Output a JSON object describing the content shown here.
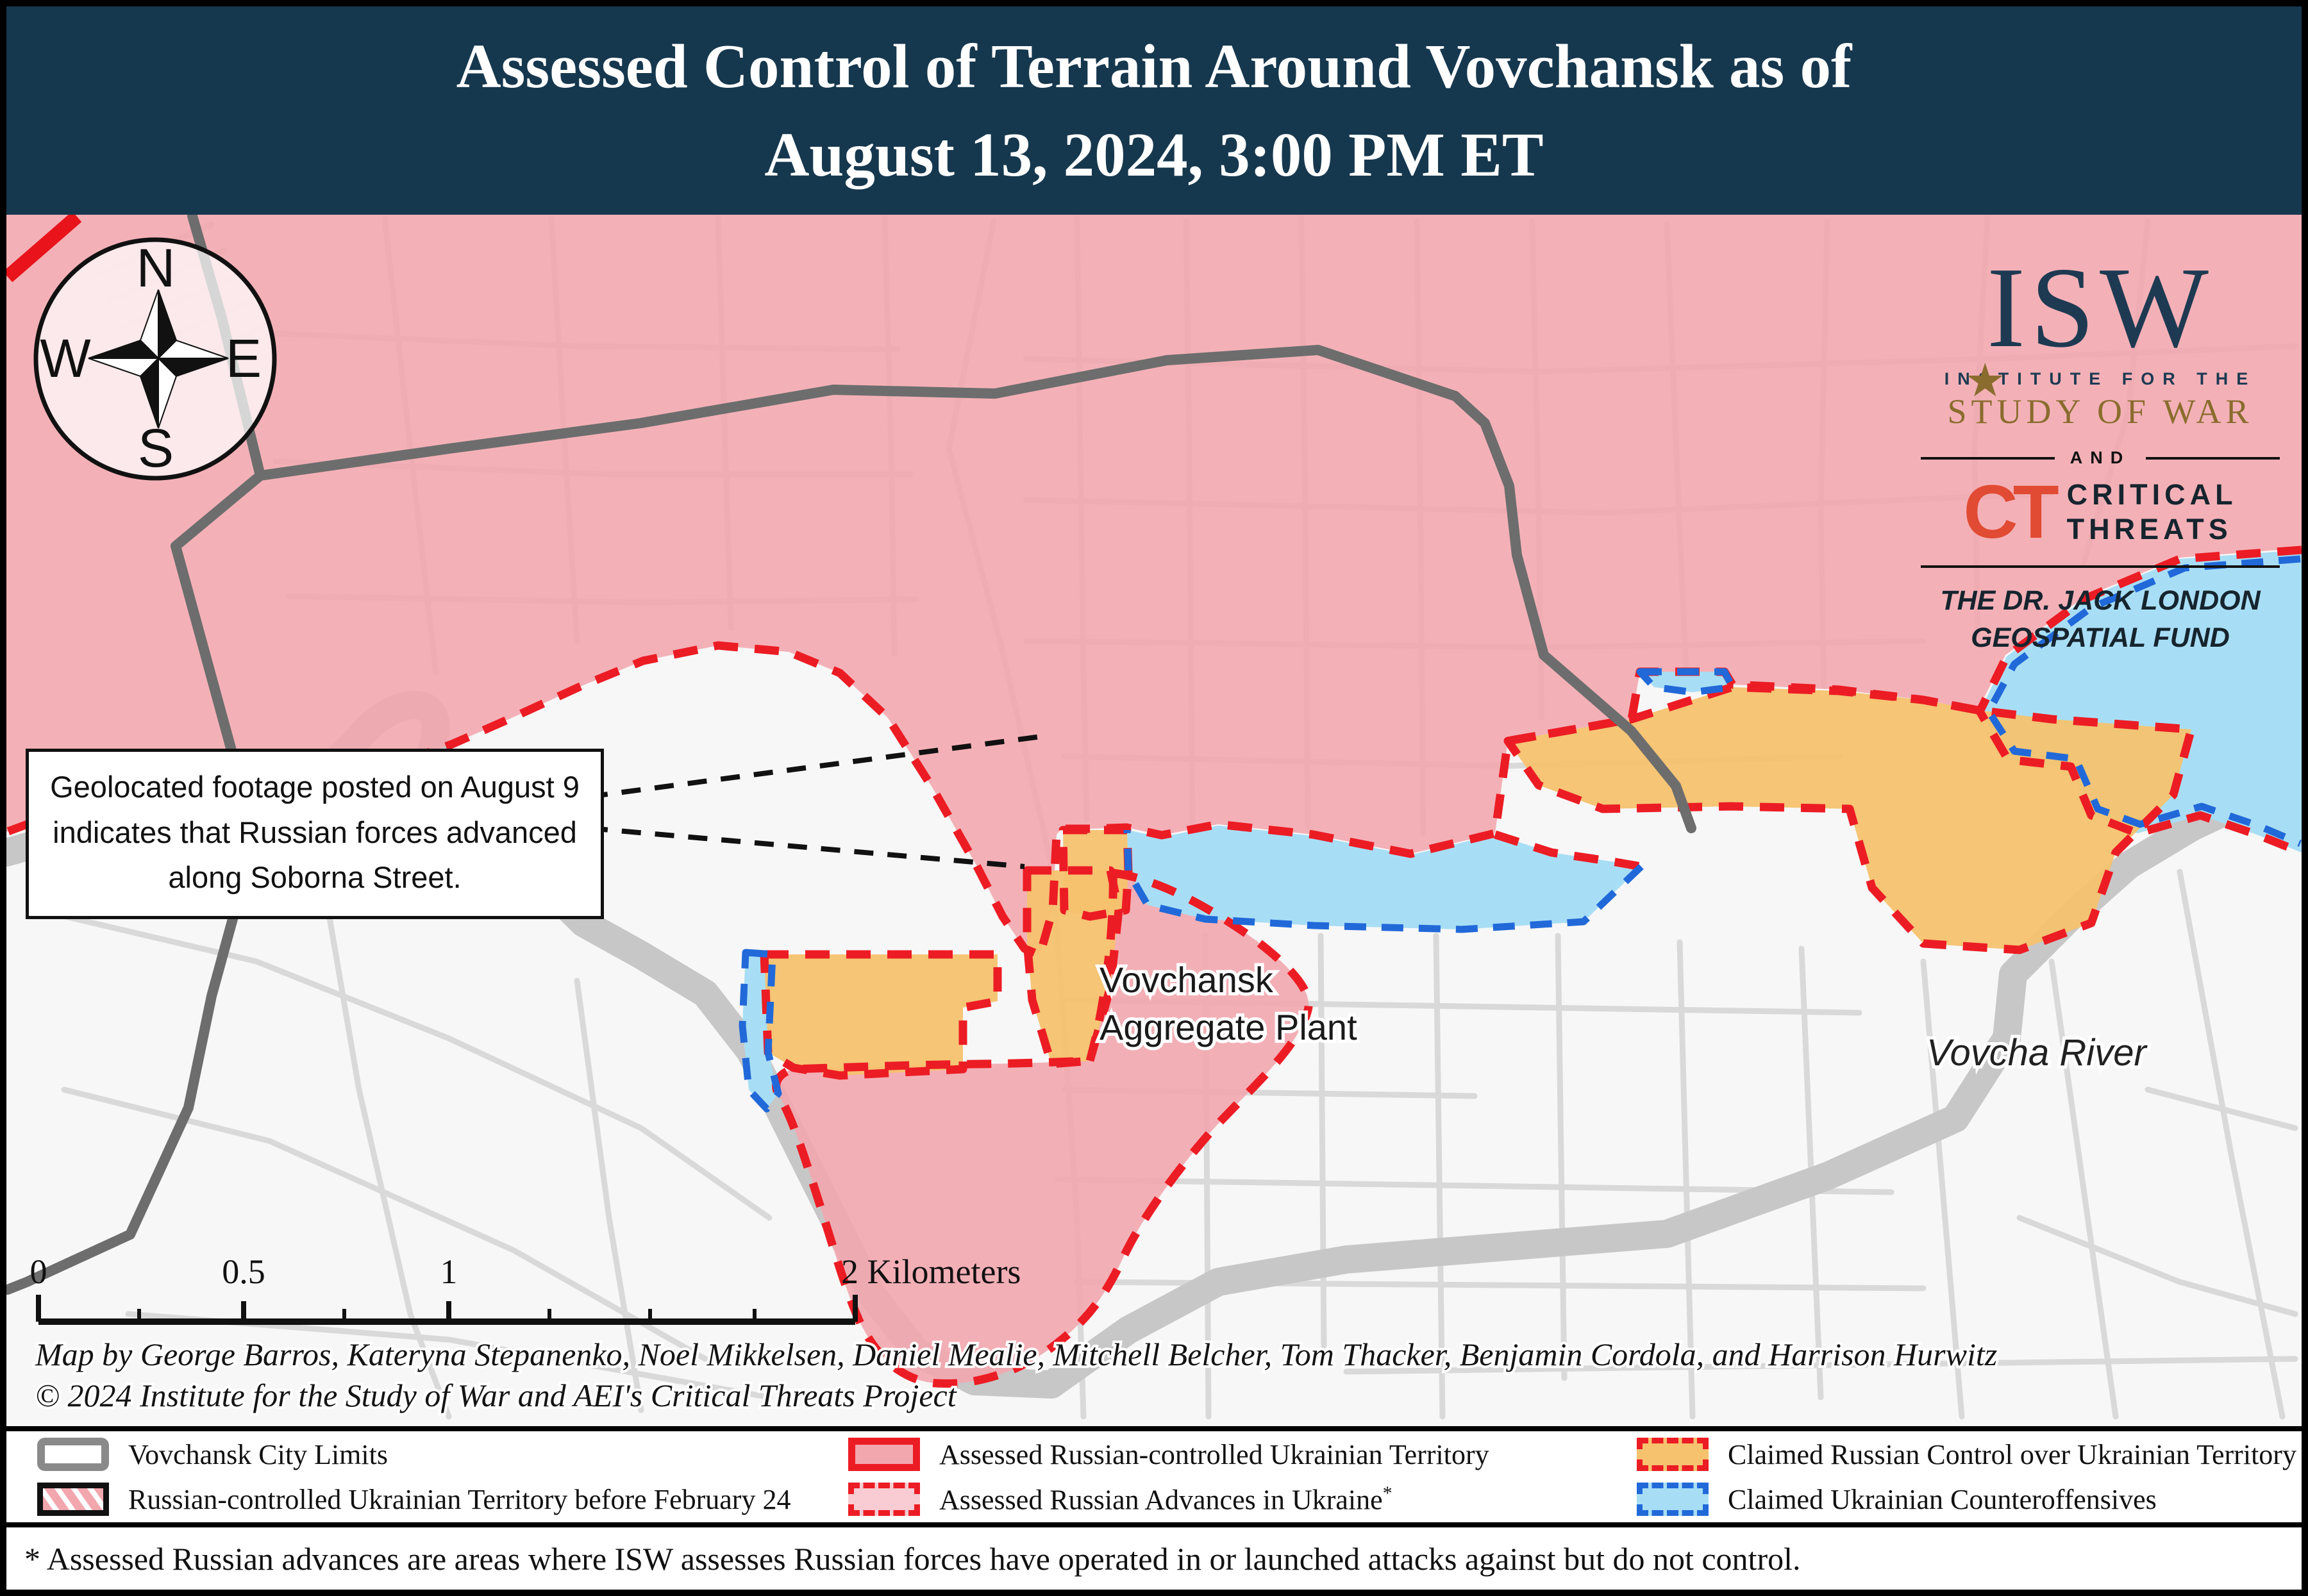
{
  "title": {
    "line1": "Assessed Control of Terrain Around Vovchansk as of",
    "line2": "August 13, 2024, 3:00 PM ET"
  },
  "logo": {
    "isw": "ISW",
    "star": "★",
    "institute": "INSTITUTE FOR THE",
    "study": "STUDY OF WAR",
    "and": "AND",
    "ct": "CT",
    "critical": "CRITICAL",
    "threats": "THREATS",
    "fund_line1": "THE DR. JACK LONDON",
    "fund_line2": "GEOSPATIAL FUND"
  },
  "compass": {
    "n": "N",
    "e": "E",
    "s": "S",
    "w": "W"
  },
  "callout": {
    "line1": "Geolocated footage posted on August 9",
    "line2": "indicates that Russian forces advanced",
    "line3": "along Soborna Street."
  },
  "map_labels": {
    "plant_line1": "Vovchansk",
    "plant_line2": "Aggregate Plant",
    "river": "Vovcha River"
  },
  "scale": {
    "t0": "0",
    "t05": "0.5",
    "t1": "1",
    "t2": "2 Kilometers"
  },
  "credits": {
    "line1": "Map by George Barros, Kateryna Stepanenko, Noel Mikkelsen, Daniel Mealie, Mitchell Belcher, Tom Thacker, Benjamin Cordola, and Harrison Hurwitz",
    "line2": "© 2024 Institute for the Study of War and AEI's Critical Threats Project"
  },
  "legend": {
    "items": [
      {
        "id": "city-limits",
        "label": "Vovchansk City Limits"
      },
      {
        "id": "pre-feb24",
        "label": "Russian-controlled Ukrainian Territory before February 24"
      },
      {
        "id": "assessed-controlled",
        "label": "Assessed Russian-controlled Ukrainian Territory"
      },
      {
        "id": "assessed-advances",
        "label": "Assessed Russian Advances in Ukraine",
        "sup": "*"
      },
      {
        "id": "claimed-russian",
        "label": "Claimed Russian Control over Ukrainian Territory"
      },
      {
        "id": "claimed-ua",
        "label": "Claimed Ukrainian Counteroffensives"
      }
    ]
  },
  "footnote": "* Assessed Russian advances are areas where ISW assesses Russian forces have operated in or launched attacks against but do not control.",
  "colors": {
    "title_bg": "#16384e",
    "russian_pink": "#f2a6ae",
    "advances_pink": "#f8ccd2",
    "claimed_orange": "#f6c26e",
    "claimed_blue": "#a8def5",
    "red_border": "#ec1c24",
    "blue_border": "#2169d9",
    "city_limits_gray": "#6d6d6d",
    "isw_navy": "#1e3a52",
    "isw_gold": "#8a6c2e",
    "ct_orange": "#e14b33"
  }
}
